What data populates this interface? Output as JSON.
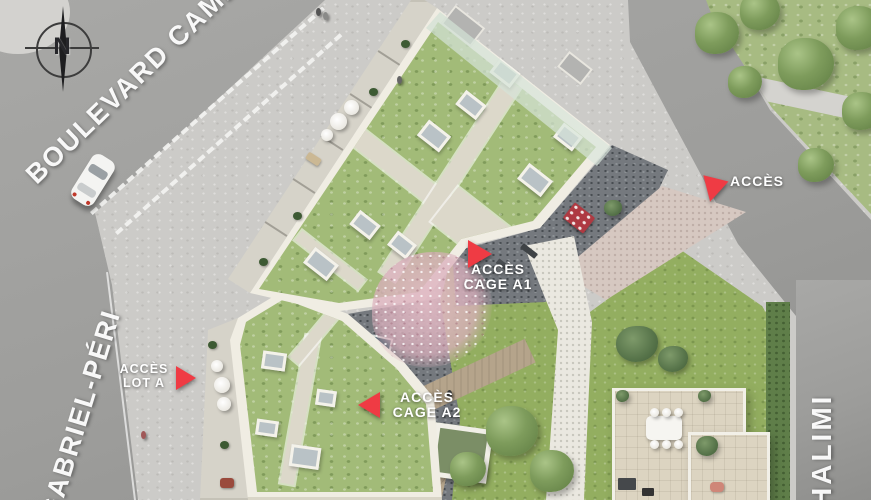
{
  "stage": {
    "width": 871,
    "height": 500
  },
  "compass": {
    "label": "N"
  },
  "streets": [
    {
      "id": "boulevard",
      "label": "BOULEVARD CAMÉL"
    },
    {
      "id": "gabriel-peri",
      "label": "GABRIEL-PÉRI"
    },
    {
      "id": "halimi",
      "label": "HALIMI"
    }
  ],
  "access_points": [
    {
      "id": "acces-top",
      "line1": "ACCÈS",
      "line2": "",
      "arrow": "down"
    },
    {
      "id": "acces-cage-a1",
      "line1": "ACCÈS",
      "line2": "CAGE A1",
      "arrow": "right"
    },
    {
      "id": "acces-cage-a2",
      "line1": "ACCÈS",
      "line2": "CAGE A2",
      "arrow": "left"
    },
    {
      "id": "acces-lot-a",
      "line1": "ACCÈS",
      "line2": "LOT A",
      "arrow": "right"
    }
  ],
  "colors": {
    "arrow_red": "#ef3b44",
    "label_white": "#ffffff"
  }
}
